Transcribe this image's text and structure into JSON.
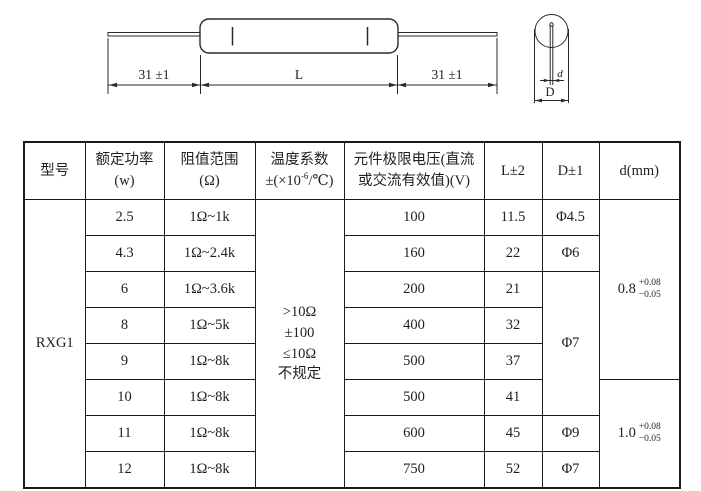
{
  "drawing": {
    "left_lead_dim": "31 ±1",
    "body_dim": "L",
    "right_lead_dim": "31 ±1",
    "lead_diameter_label": "d",
    "body_diameter_label": "D"
  },
  "table": {
    "headers": {
      "model": "型号",
      "power_line1": "额定功率",
      "power_line2": "(w)",
      "resistance_line1": "阻值范围",
      "resistance_line2": "(Ω)",
      "temp_line1": "温度系数",
      "temp_line2_prefix": "±(×10",
      "temp_line2_exponent": "-6",
      "temp_line2_suffix": "/℃)",
      "voltage_line1": "元件极限电压(直流",
      "voltage_line2": "或交流有效值)(V)",
      "length": "L±2",
      "diameter": "D±1",
      "lead": "d(mm)"
    },
    "model": "RXG1",
    "temp_coefficient_lines": [
      ">10Ω",
      "±100",
      "≤10Ω",
      "不规定"
    ],
    "rows": [
      {
        "power": "2.5",
        "resistance_range": "1Ω~1k",
        "limit_voltage": "100",
        "length": "11.5"
      },
      {
        "power": "4.3",
        "resistance_range": "1Ω~2.4k",
        "limit_voltage": "160",
        "length": "22"
      },
      {
        "power": "6",
        "resistance_range": "1Ω~3.6k",
        "limit_voltage": "200",
        "length": "21"
      },
      {
        "power": "8",
        "resistance_range": "1Ω~5k",
        "limit_voltage": "400",
        "length": "32"
      },
      {
        "power": "9",
        "resistance_range": "1Ω~8k",
        "limit_voltage": "500",
        "length": "37"
      },
      {
        "power": "10",
        "resistance_range": "1Ω~8k",
        "limit_voltage": "500",
        "length": "41"
      },
      {
        "power": "11",
        "resistance_range": "1Ω~8k",
        "limit_voltage": "600",
        "length": "45"
      },
      {
        "power": "12",
        "resistance_range": "1Ω~8k",
        "limit_voltage": "750",
        "length": "52"
      }
    ],
    "diameter_cells": [
      {
        "label": "Φ4.5"
      },
      {
        "label": "Φ6"
      },
      {
        "label": "Φ7"
      },
      {
        "label": "Φ9"
      },
      {
        "label": "Φ7"
      }
    ],
    "lead_diameter_cells": [
      {
        "value": "0.8",
        "upper": "+0.08",
        "lower": "−0.05"
      },
      {
        "value": "1.0",
        "upper": "+0.08",
        "lower": "−0.05"
      }
    ]
  }
}
